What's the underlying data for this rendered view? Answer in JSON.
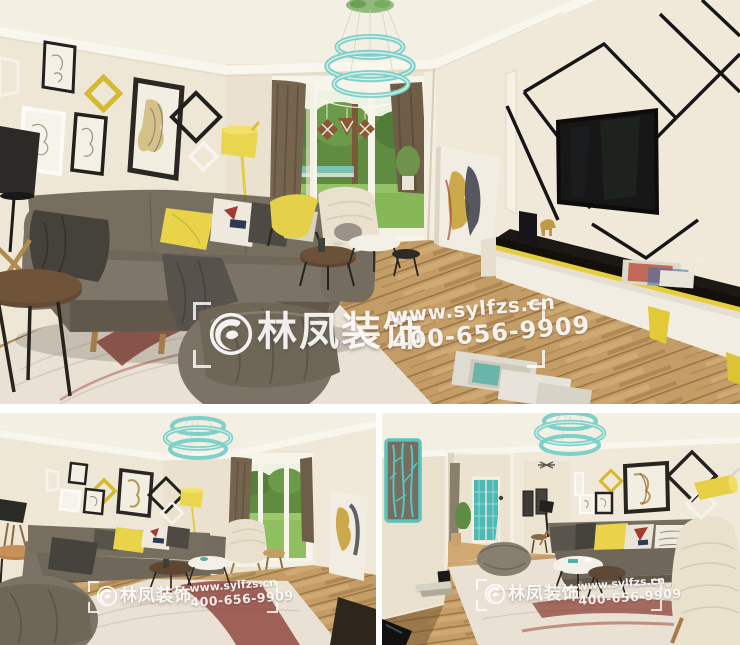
{
  "collage": {
    "panels": [
      {
        "name": "living-room-main-view"
      },
      {
        "name": "living-room-wide-view"
      },
      {
        "name": "living-room-entry-view"
      }
    ]
  },
  "watermark": {
    "brand": "林凤装饰",
    "website": "www.sylfzs.cn",
    "phone": "400-656-9909"
  },
  "palette": {
    "wall": "#efe8d8",
    "ceiling": "#f4efe3",
    "wood_floor": "#c49d66",
    "sofa_gray": "#716a5c",
    "accent_yellow": "#e8d34a",
    "accent_teal": "#7ed0c8",
    "rug_cream": "#e9e2d4",
    "rug_red": "#8c4038",
    "curtain_brown": "#75654e",
    "grass_green": "#86b757",
    "line_black": "#161616"
  }
}
